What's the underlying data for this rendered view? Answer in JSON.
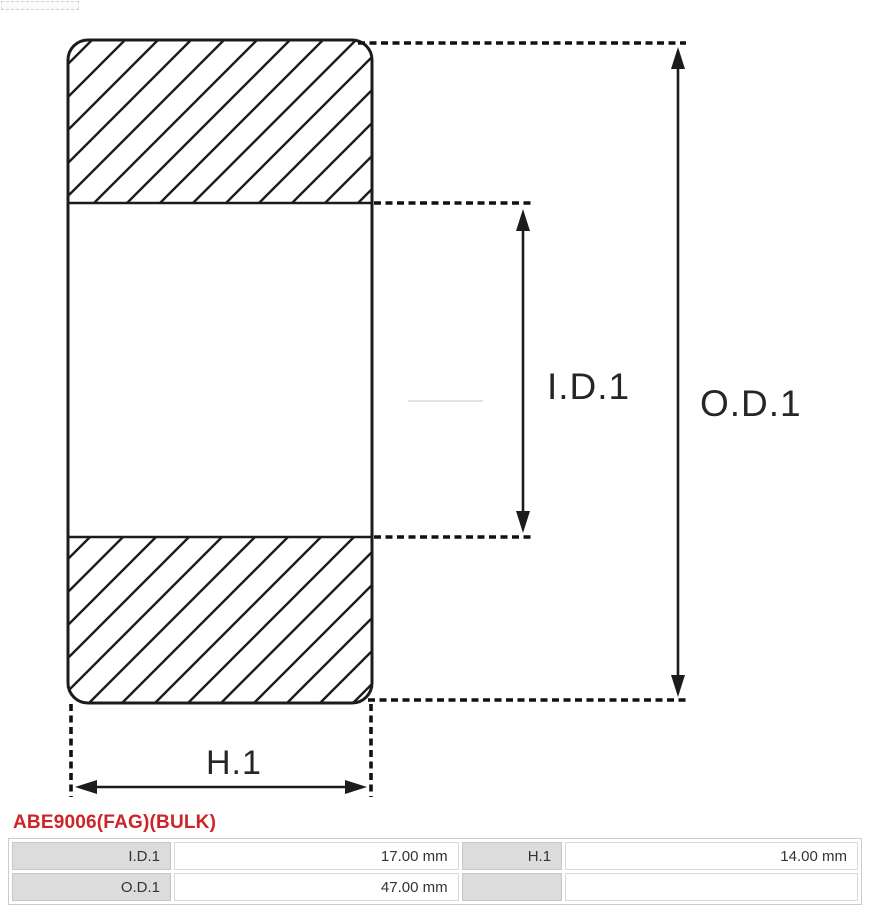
{
  "diagram": {
    "labels": {
      "inner_diameter": "I.D.1",
      "outer_diameter": "O.D.1",
      "width_dim": "H.1"
    },
    "line_color": "#1c1c1c"
  },
  "part_title": {
    "text": "ABE9006(FAG)(BULK)",
    "color": "#cc2428"
  },
  "spec_table": {
    "rows": [
      {
        "cells": [
          {
            "label": "I.D.1",
            "value": "17.00 mm"
          },
          {
            "label": "H.1",
            "value": "14.00 mm"
          }
        ]
      },
      {
        "cells": [
          {
            "label": "O.D.1",
            "value": "47.00 mm"
          },
          {
            "label": "",
            "value": ""
          }
        ]
      }
    ]
  }
}
